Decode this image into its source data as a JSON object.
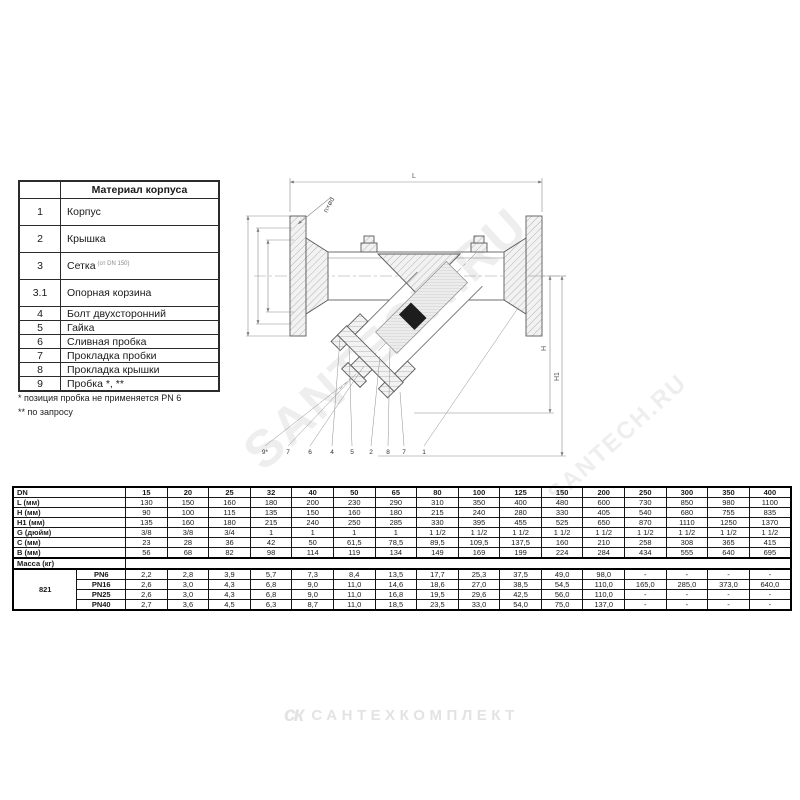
{
  "materials_table": {
    "header": "Материал корпуса",
    "rows": [
      {
        "num": "1",
        "name": "Корпус",
        "note": ""
      },
      {
        "num": "2",
        "name": "Крышка",
        "note": ""
      },
      {
        "num": "3",
        "name": "Сетка",
        "note": "(от DN 150)"
      },
      {
        "num": "3.1",
        "name": "Опорная корзина",
        "note": ""
      },
      {
        "num": "4",
        "name": "Болт двухсторонний",
        "note": ""
      },
      {
        "num": "5",
        "name": "Гайка",
        "note": ""
      },
      {
        "num": "6",
        "name": "Сливная пробка",
        "note": ""
      },
      {
        "num": "7",
        "name": "Прокладка пробки",
        "note": ""
      },
      {
        "num": "8",
        "name": "Прокладка крышки",
        "note": ""
      },
      {
        "num": "9",
        "name": "Пробка *, **",
        "note": ""
      }
    ]
  },
  "footnotes": [
    "* позиция пробка не применяется PN 6",
    "** по запросу"
  ],
  "drawing": {
    "dim_labels": {
      "length": "L",
      "holes": "n×ød",
      "height": "H",
      "height1": "H1"
    },
    "callouts": [
      "9*",
      "7",
      "6",
      "4",
      "5",
      "2",
      "8",
      "7",
      "1"
    ]
  },
  "dim_table": {
    "corner_label": "DN",
    "dn": [
      "15",
      "20",
      "25",
      "32",
      "40",
      "50",
      "65",
      "80",
      "100",
      "125",
      "150",
      "200",
      "250",
      "300",
      "350",
      "400"
    ],
    "rows": [
      {
        "label": "L (мм)",
        "values": [
          "130",
          "150",
          "160",
          "180",
          "200",
          "230",
          "290",
          "310",
          "350",
          "400",
          "480",
          "600",
          "730",
          "850",
          "980",
          "1100"
        ]
      },
      {
        "label": "H (мм)",
        "values": [
          "90",
          "100",
          "115",
          "135",
          "150",
          "160",
          "180",
          "215",
          "240",
          "280",
          "330",
          "405",
          "540",
          "680",
          "755",
          "835"
        ]
      },
      {
        "label": "H1 (мм)",
        "values": [
          "135",
          "160",
          "180",
          "215",
          "240",
          "250",
          "285",
          "330",
          "395",
          "455",
          "525",
          "650",
          "870",
          "1110",
          "1250",
          "1370"
        ]
      },
      {
        "label": "G (дюйм)",
        "values": [
          "3/8",
          "3/8",
          "3/4",
          "1",
          "1",
          "1",
          "1",
          "1 1/2",
          "1 1/2",
          "1 1/2",
          "1 1/2",
          "1 1/2",
          "1 1/2",
          "1 1/2",
          "1 1/2",
          "1 1/2"
        ]
      },
      {
        "label": "C (мм)",
        "values": [
          "23",
          "28",
          "36",
          "42",
          "50",
          "61,5",
          "78,5",
          "89,5",
          "109,5",
          "137,5",
          "160",
          "210",
          "258",
          "308",
          "365",
          "415"
        ]
      },
      {
        "label": "B (мм)",
        "values": [
          "56",
          "68",
          "82",
          "98",
          "114",
          "119",
          "134",
          "149",
          "169",
          "199",
          "224",
          "284",
          "434",
          "555",
          "640",
          "695"
        ]
      }
    ],
    "mass_label": "Масса (кг)",
    "series_label": "821",
    "mass_rows": [
      {
        "label": "PN6",
        "values": [
          "2,2",
          "2,8",
          "3,9",
          "5,7",
          "7,3",
          "8,4",
          "13,5",
          "17,7",
          "25,3",
          "37,5",
          "49,0",
          "98,0",
          "-",
          "-",
          "-",
          "-"
        ]
      },
      {
        "label": "PN16",
        "values": [
          "2,6",
          "3,0",
          "4,3",
          "6,8",
          "9,0",
          "11,0",
          "14,6",
          "18,6",
          "27,0",
          "38,5",
          "54,5",
          "110,0",
          "165,0",
          "285,0",
          "373,0",
          "640,0"
        ]
      },
      {
        "label": "PN25",
        "values": [
          "2,6",
          "3,0",
          "4,3",
          "6,8",
          "9,0",
          "11,0",
          "16,8",
          "19,5",
          "29,6",
          "42,5",
          "56,0",
          "110,0",
          "-",
          "-",
          "-",
          "-"
        ]
      },
      {
        "label": "PN40",
        "values": [
          "2,7",
          "3,6",
          "4,5",
          "6,3",
          "8,7",
          "11,0",
          "18,5",
          "23,5",
          "33,0",
          "54,0",
          "75,0",
          "137,0",
          "-",
          "-",
          "-",
          "-"
        ]
      }
    ]
  },
  "branding": {
    "watermark": "SANTECH.RU",
    "logo_glyph": "ск",
    "logo_text": "САНТЕХКОМПЛЕКТ"
  }
}
